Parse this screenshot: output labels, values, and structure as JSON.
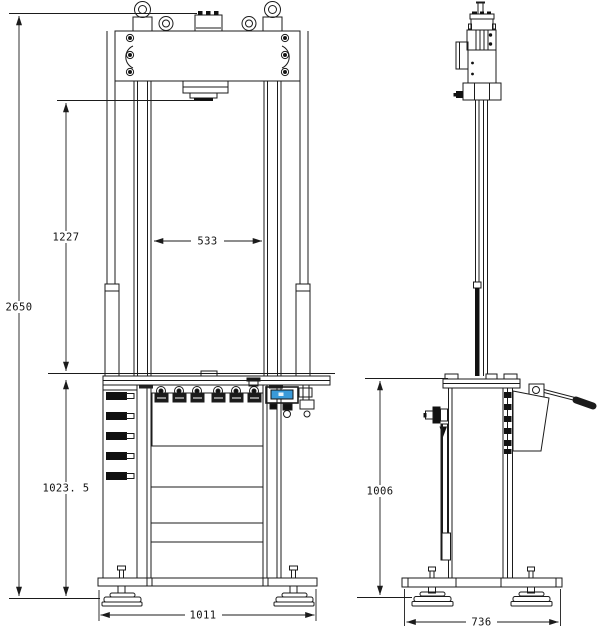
{
  "drawing": {
    "dimensions": {
      "overall_height": "2650",
      "ram_to_table": "1227",
      "column_gap": "533",
      "table_height_front": "1023. 5",
      "base_width_front": "1011",
      "table_height_side": "1006",
      "base_width_side": "736"
    },
    "colors": {
      "line": "#1b1b1b",
      "accent_blue": "#3a9ad9",
      "background": "#ffffff"
    }
  }
}
